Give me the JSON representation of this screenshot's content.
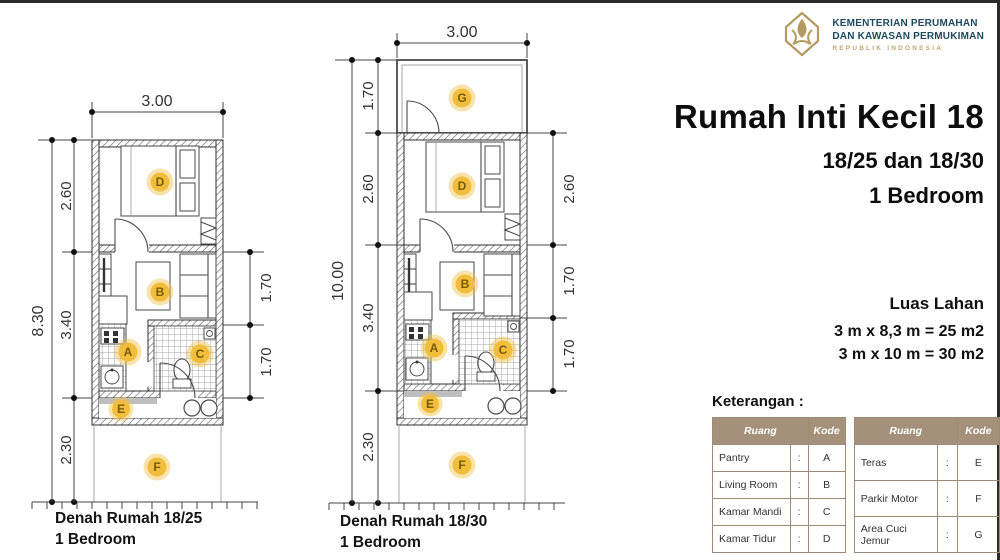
{
  "logo": {
    "line1": "KEMENTERIAN PERUMAHAN",
    "line2": "DAN KAWASAN PERMUKIMAN",
    "line3": "REPUBLIK INDONESIA"
  },
  "title": {
    "main": "Rumah Inti Kecil 18",
    "sub1": "18/25 dan 18/30",
    "sub2": "1 Bedroom"
  },
  "luas_lahan": {
    "heading": "Luas Lahan",
    "line1": "3 m x 8,3 m = 25 m2",
    "line2": "3 m x 10 m = 30 m2"
  },
  "keterangan": {
    "heading": "Keterangan :",
    "header": {
      "ruang": "Ruang",
      "kode": "Kode"
    },
    "separator": ":",
    "table1": [
      {
        "ruang": "Pantry",
        "kode": "A"
      },
      {
        "ruang": "Living Room",
        "kode": "B"
      },
      {
        "ruang": "Kamar Mandi",
        "kode": "C"
      },
      {
        "ruang": "Kamar Tidur",
        "kode": "D"
      }
    ],
    "table2": [
      {
        "ruang": "Teras",
        "kode": "E"
      },
      {
        "ruang": "Parkir Motor",
        "kode": "F"
      },
      {
        "ruang": "Area Cuci Jemur",
        "kode": "G"
      }
    ]
  },
  "plans": {
    "left": {
      "caption_line1": "Denah Rumah 18/25",
      "caption_line2": "1 Bedroom",
      "dim_top": "3.00",
      "dim_total": "8.30",
      "dim_left": [
        "2.60",
        "3.40",
        "2.30"
      ],
      "dim_right": [
        "1.70",
        "1.70"
      ],
      "room_labels": [
        "D",
        "B",
        "A",
        "C",
        "E",
        "F"
      ]
    },
    "right": {
      "caption_line1": "Denah Rumah 18/30",
      "caption_line2": "1 Bedroom",
      "dim_top": "3.00",
      "dim_total": "10.00",
      "dim_left": [
        "1.70",
        "2.60",
        "3.40",
        "2.30"
      ],
      "dim_right": [
        "2.60",
        "1.70",
        "1.70"
      ],
      "room_labels": [
        "G",
        "D",
        "B",
        "A",
        "C",
        "E",
        "F"
      ]
    }
  },
  "colors": {
    "accent_room_marker": "#F1C04A",
    "table_header_bg": "#A5917B",
    "logo_gold": "#B49A5F",
    "logo_text": "#1D4A5E",
    "page_border": "#2B2B2B"
  }
}
